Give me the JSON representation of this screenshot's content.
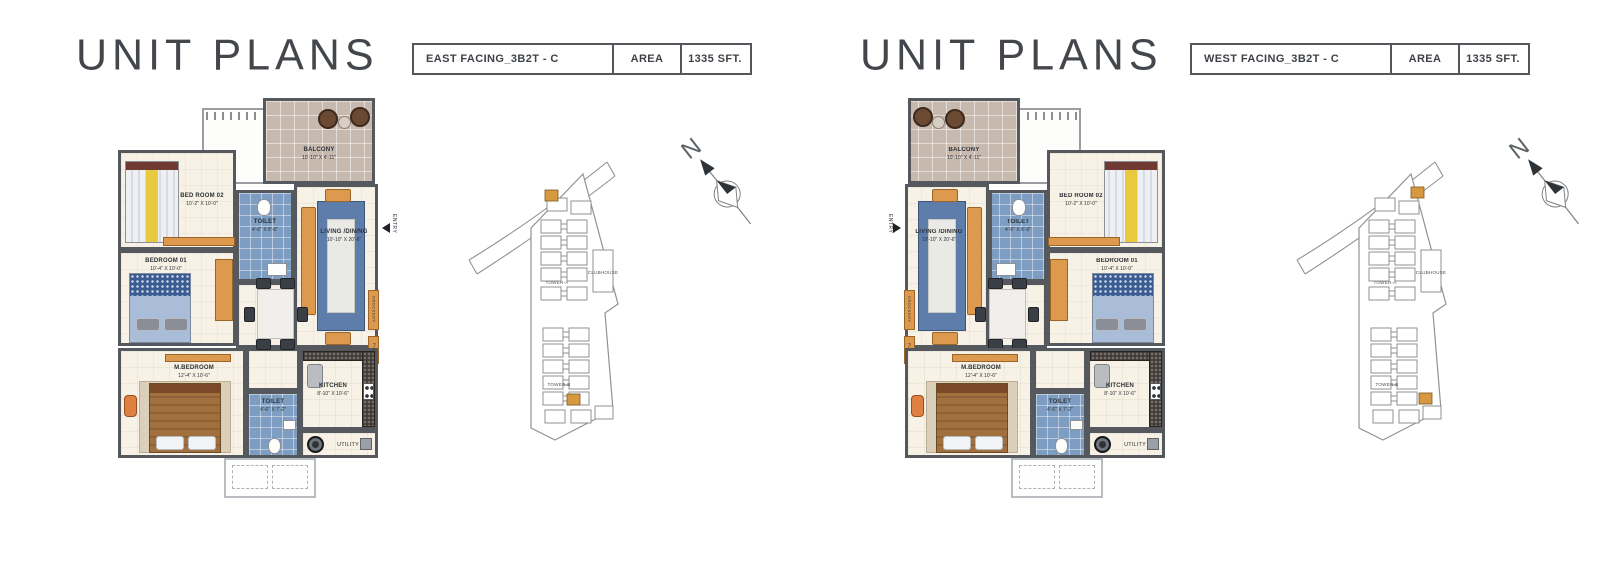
{
  "panels": [
    {
      "title": "UNIT PLANS",
      "unit_name": "EAST FACING_3B2T - C",
      "area_label": "AREA",
      "area_value": "1335 SFT."
    },
    {
      "title": "UNIT PLANS",
      "unit_name": "WEST FACING_3B2T - C",
      "area_label": "AREA",
      "area_value": "1335 SFT."
    }
  ],
  "floor_plan": {
    "rooms": {
      "balcony": {
        "name": "BALCONY",
        "dims": "10'-10\" X 4'-11\""
      },
      "bedroom2": {
        "name": "BED ROOM 02",
        "dims": "10'-2\" X 10'-0\""
      },
      "toilet2": {
        "name": "TOILET",
        "dims": "4'-6\" X 8'-6\""
      },
      "living": {
        "name": "LIVING /DINING",
        "dims": "10'-10\" X 20'-6\""
      },
      "bedroom1": {
        "name": "BEDROOM 01",
        "dims": "10'-4\" X 10'-0\""
      },
      "mbedroom": {
        "name": "M.BEDROOM",
        "dims": "12'-4\" X 10'-6\""
      },
      "toilet1": {
        "name": "TOILET",
        "dims": "4'-6\" X 7'-2\""
      },
      "kitchen": {
        "name": "KITCHEN",
        "dims": "8'-10\" X 10'-6\""
      }
    },
    "labels": {
      "utility": "UTILITY",
      "entry": "ENTRY",
      "crockery": "CROCKERY",
      "puja": "PUJA"
    }
  },
  "site_map": {
    "tower_a": "TOWER-A",
    "tower_b": "TOWER-B",
    "clubhouse": "CLUBHOUSE",
    "north_label": "N"
  },
  "colors": {
    "accent_orange": "#dd9a4e",
    "toilet_blue": "#7d9dc2",
    "wall_gray": "#55585d",
    "title_text": "#43474c"
  }
}
